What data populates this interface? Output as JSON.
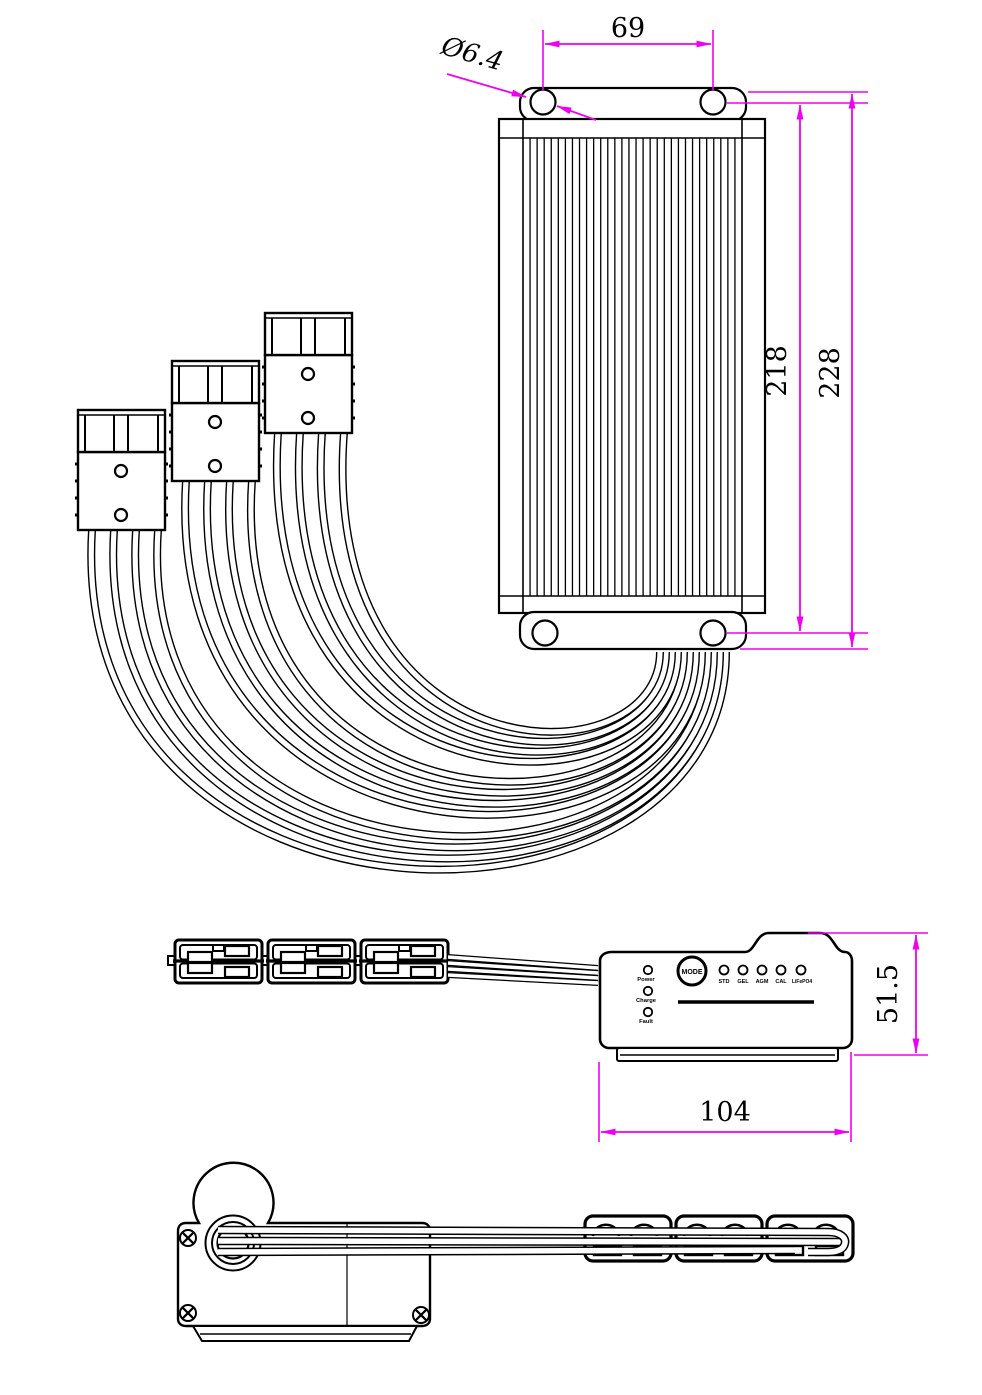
{
  "drawing": {
    "dimensions": {
      "top_hole_spacing": "69",
      "hole_diameter": "Ø6.4",
      "fin_body_height": "218",
      "overall_height": "228",
      "controller_height": "51.5",
      "controller_width": "104"
    },
    "panel": {
      "mode_button": "MODE",
      "status_leds": [
        "Power",
        "Charge",
        "Fault"
      ],
      "mode_leds": [
        "STD",
        "GEL",
        "AGM",
        "CAL",
        "LiFePO4"
      ]
    },
    "colors": {
      "dimension_lines": "#f000f0",
      "outline": "#000000",
      "background": "#ffffff"
    }
  }
}
